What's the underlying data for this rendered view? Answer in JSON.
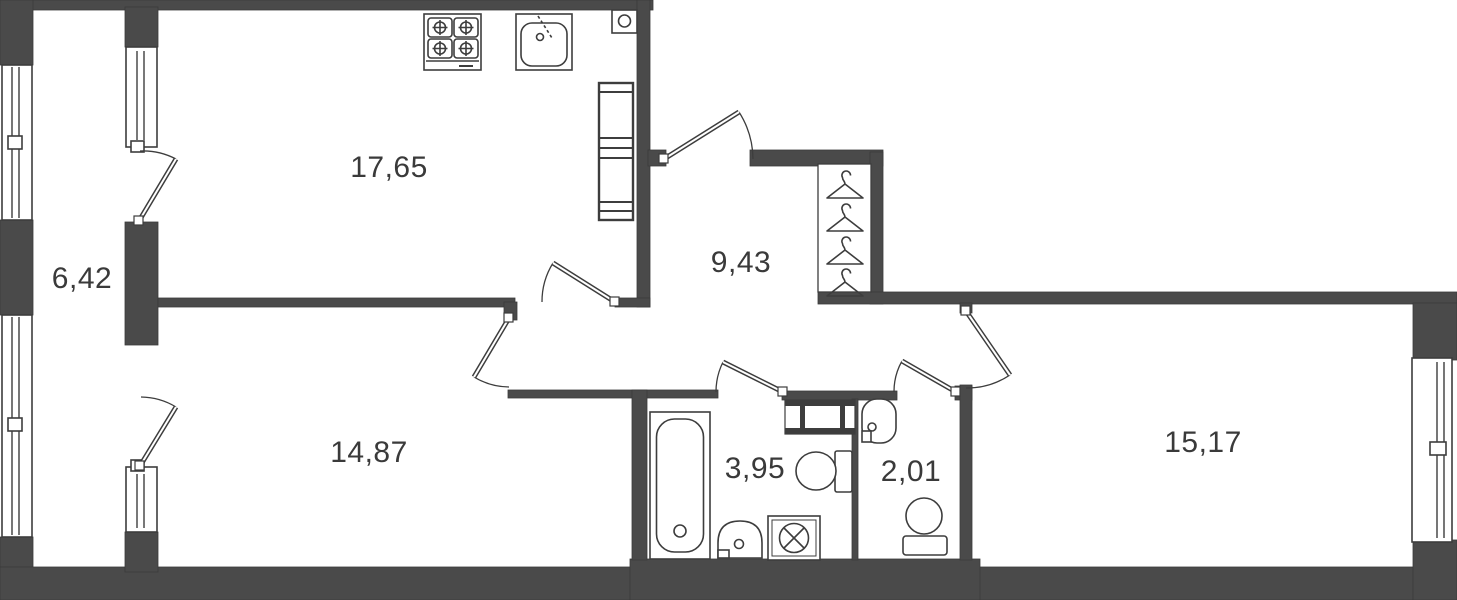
{
  "colors": {
    "wall": "#4a4a4a",
    "outline": "#3d3d3d",
    "label_text": "#3a3a3a",
    "background": "#ffffff"
  },
  "rooms": [
    {
      "id": "kitchen",
      "area_label": "17,65"
    },
    {
      "id": "balcony",
      "area_label": "6,42"
    },
    {
      "id": "hallway",
      "area_label": "9,43"
    },
    {
      "id": "bedroom",
      "area_label": "14,87"
    },
    {
      "id": "bathroom",
      "area_label": "3,95"
    },
    {
      "id": "toilet",
      "area_label": "2,01"
    },
    {
      "id": "living-room",
      "area_label": "15,17"
    }
  ],
  "icons": [
    "stove-icon",
    "kitchen-sink-icon",
    "vent-shaft-icon",
    "tall-cabinet-icon",
    "hanger-icon",
    "bathtub-icon",
    "washbasin-icon",
    "washing-machine-icon",
    "toilet-icon",
    "window-icon",
    "door-swing-icon"
  ]
}
